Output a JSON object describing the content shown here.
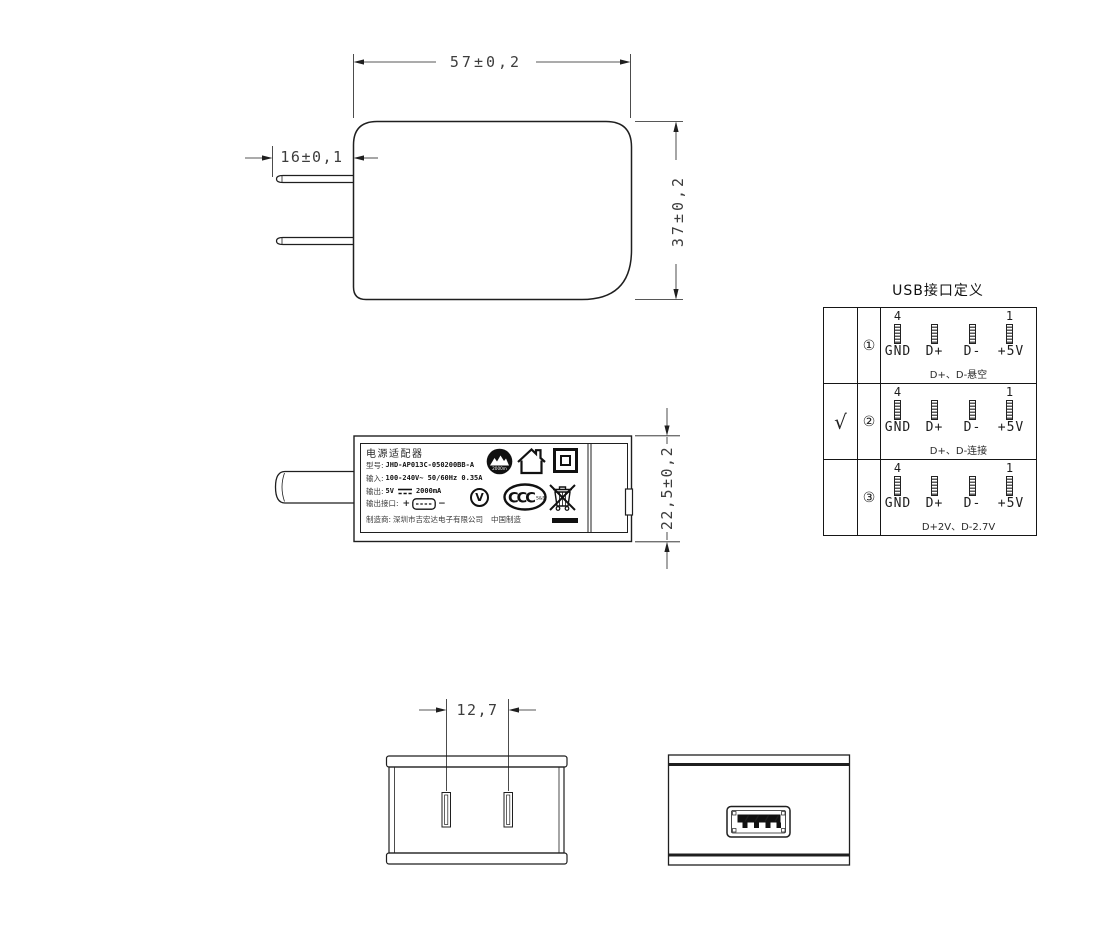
{
  "drawing": {
    "front_view": {
      "width_dim": "57±0,2",
      "height_dim": "37±0,2",
      "prong_dim": "16±0,1"
    },
    "side_view": {
      "height_dim": "22,5±0,2"
    },
    "plug_face_view": {
      "pin_pitch_dim": "12,7"
    },
    "label": {
      "title": "电源适配器",
      "model_key": "型号:",
      "model_value": "JHD-AP013C-050200BB-A",
      "input_key": "输入:",
      "input_value": "100-240V~  50/60Hz  0.35A",
      "output_key": "输出:",
      "output_voltage": "5V",
      "output_current": "2000mA",
      "port_key": "输出接口:",
      "port_plus": "+",
      "port_minus": "−",
      "maker_key": "制造商:",
      "maker_value": "深圳市吉宏达电子有限公司",
      "origin": "中国制造",
      "altitude_mark_text": "2000m",
      "efficiency_mark_text": "V",
      "ccc_mark_text": "CCC",
      "ccc_mark_sub": "S&E"
    },
    "usb_table": {
      "title": "USB接口定义",
      "pin_number_first": "4",
      "pin_number_last": "1",
      "pin_labels": [
        "GND",
        "D+",
        "D-",
        "+5V"
      ],
      "rows": [
        {
          "selected": "",
          "index": "①",
          "note": "D+、D-悬空"
        },
        {
          "selected": "√",
          "index": "②",
          "note": "D+、D-连接"
        },
        {
          "selected": "",
          "index": "③",
          "note": "D+2V、D-2.7V"
        }
      ]
    }
  }
}
